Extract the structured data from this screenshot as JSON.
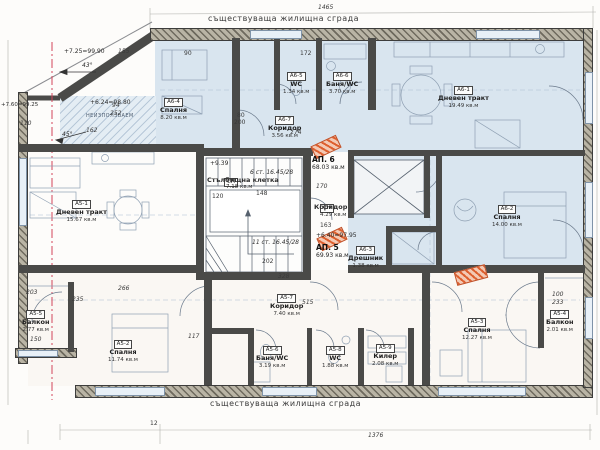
{
  "meta": {
    "title_top": "съществуваща жилищна сграда",
    "title_bottom": "съществуваща жилищна сграда",
    "dim_top": "1465",
    "dim_bottom": "1376"
  },
  "apartments": [
    {
      "code": "АП. 6",
      "area": "68.03 кв.м"
    },
    {
      "code": "АП. 5",
      "area": "69.93 кв.м"
    }
  ],
  "stairwell": {
    "badge": "СН",
    "name": "Стълбищна клетка",
    "area": "7.18 кв.м",
    "elevation": "+9.39",
    "steps_up": "6 ст. 16.45/28",
    "steps_down": "11 ст. 16.45/28"
  },
  "corridor_common": {
    "badge": "СН",
    "name": "Коридор",
    "area": "4.29 кв.м",
    "elevation": "+6.40=97.95"
  },
  "annotations": {
    "elev1": "+7.25=99.90",
    "angle1": "43°",
    "elev2": "+6.24=98.80",
    "unused": "НЕИЗПОЛЗВАЕМ",
    "angle2": "45°",
    "elev3": "+7.60=99.25"
  },
  "rooms": [
    {
      "code": "А6-4",
      "name": "Спалня",
      "area": "8.20 кв.м"
    },
    {
      "code": "А6-5",
      "name": "WC",
      "area": "1.34 кв.м"
    },
    {
      "code": "А6-6",
      "name": "Баня/WC",
      "area": "3.70 кв.м"
    },
    {
      "code": "А6-7",
      "name": "Коридор",
      "area": "3.56 кв.м"
    },
    {
      "code": "А6-1",
      "name": "Дневен тракт",
      "area": "19.49 кв.м"
    },
    {
      "code": "А6-2",
      "name": "Спалня",
      "area": "14.00 кв.м"
    },
    {
      "code": "А6-3",
      "name": "Дрешник",
      "area": "1.38 кв.м"
    },
    {
      "code": "А5-1",
      "name": "Дневен тракт",
      "area": "15.67 кв.м"
    },
    {
      "code": "А5-2",
      "name": "Спалня",
      "area": "11.74 кв.м"
    },
    {
      "code": "А5-3",
      "name": "Спалня",
      "area": "12.27 кв.м"
    },
    {
      "code": "А5-4",
      "name": "Балкон",
      "area": "2.01 кв.м"
    },
    {
      "code": "А5-5",
      "name": "Балкон",
      "area": "2.77 кв.м"
    },
    {
      "code": "А5-6",
      "name": "Баня/WC",
      "area": "3.19 кв.м"
    },
    {
      "code": "А5-7",
      "name": "Коридор",
      "area": "7.40 кв.м"
    },
    {
      "code": "А5-8",
      "name": "WC",
      "area": "1.88 кв.м"
    },
    {
      "code": "А5-9",
      "name": "Килер",
      "area": "2.08 кв.м"
    }
  ],
  "dims": [
    "155",
    "90",
    "172",
    "110",
    "94",
    "252",
    "162",
    "80",
    "200",
    "274",
    "148",
    "170",
    "120",
    "163",
    "202",
    "328",
    "515",
    "266",
    "203",
    "235",
    "150",
    "117",
    "100",
    "233",
    "12"
  ],
  "colors": {
    "apartment6_fill": "#d9e5ef",
    "wall": "#4a4a48",
    "section_line": "#d3455b",
    "marker": "#de5f2e"
  }
}
